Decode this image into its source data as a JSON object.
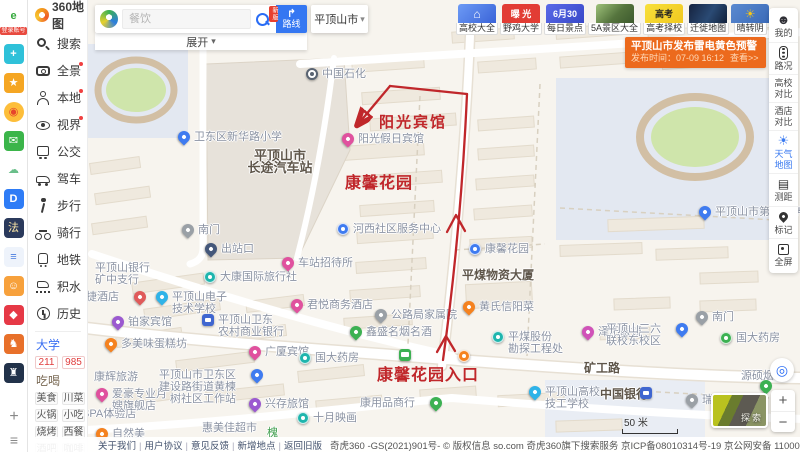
{
  "browser_strip": {
    "login_badge": "登录账号",
    "plus": "+",
    "menu": "≡",
    "icons": [
      {
        "name": "browser-e-logo",
        "glyph": "e",
        "bg": "#ffffff",
        "fg": "#35a93c",
        "bold": true,
        "first": true
      },
      {
        "name": "health-app-icon",
        "glyph": "+",
        "bg": "#2fc1d9",
        "fg": "#ffffff",
        "bold": true
      },
      {
        "name": "favorites-star-icon",
        "glyph": "★",
        "bg": "#f5a623",
        "fg": "#ffffff"
      },
      {
        "name": "weibo-icon",
        "glyph": "◉",
        "bg": "#fdbe3a",
        "fg": "#e6462c",
        "round": true
      },
      {
        "name": "mail-icon",
        "glyph": "✉",
        "bg": "#3bb54a",
        "fg": "#ffffff"
      },
      {
        "name": "cloud-icon",
        "glyph": "☁",
        "bg": "#ffffff",
        "fg": "#6abf8a"
      },
      {
        "name": "d-app-icon",
        "glyph": "D",
        "bg": "#2e7cf6",
        "fg": "#ffffff",
        "bold": true
      },
      {
        "name": "law-qa-icon",
        "glyph": "法",
        "bg": "#2b3a5c",
        "fg": "#ffe9a8"
      },
      {
        "name": "doc-icon",
        "glyph": "≡",
        "bg": "#eef3fb",
        "fg": "#4a7de0",
        "bold": true
      },
      {
        "name": "game-monkey-icon",
        "glyph": "☺",
        "bg": "#f7a13c",
        "fg": "#ffffff"
      },
      {
        "name": "red-app-icon",
        "glyph": "◆",
        "bg": "#e63946",
        "fg": "#ffffff"
      },
      {
        "name": "game-fight-icon",
        "glyph": "♞",
        "bg": "#e8702a",
        "fg": "#ffffff"
      },
      {
        "name": "game-dark-icon",
        "glyph": "♜",
        "bg": "#22324a",
        "fg": "#ffffff"
      }
    ]
  },
  "sidebar": {
    "logo_text": "360地图",
    "items": [
      {
        "label": "搜索",
        "icon": "search",
        "badge": false
      },
      {
        "label": "全景",
        "icon": "pano",
        "badge": true
      },
      {
        "label": "本地",
        "icon": "local",
        "badge": true
      },
      {
        "label": "视界",
        "icon": "view",
        "badge": true
      },
      {
        "label": "公交",
        "icon": "bus",
        "badge": false
      },
      {
        "label": "驾车",
        "icon": "car",
        "badge": false
      },
      {
        "label": "步行",
        "icon": "walk",
        "badge": false
      },
      {
        "label": "骑行",
        "icon": "bike",
        "badge": false
      },
      {
        "label": "地铁",
        "icon": "metro",
        "badge": false
      },
      {
        "label": "积水",
        "icon": "flood",
        "badge": false
      },
      {
        "label": "历史",
        "icon": "history",
        "badge": false
      }
    ],
    "university": {
      "title": "大学",
      "tags": [
        "211",
        "985"
      ]
    },
    "food": {
      "title": "吃喝",
      "tags": [
        "美食",
        "川菜",
        "火锅",
        "小吃",
        "烧烤",
        "西餐",
        "酒吧",
        "咖啡"
      ]
    }
  },
  "search": {
    "placeholder": "餐饮",
    "route_label": "路线",
    "route_badge": "新版",
    "city": "平顶山市",
    "expand_label": "展开"
  },
  "top_chips": [
    {
      "label": "高校大全",
      "tile": "uni",
      "tile_text": "⌂"
    },
    {
      "label": "野鸡大学",
      "tile": "expose",
      "tile_text": "曝 光"
    },
    {
      "label": "每日景点",
      "tile": "daily",
      "tile_text": "6月30"
    },
    {
      "label": "5A景区大全",
      "tile": "scenic",
      "tile_text": ""
    },
    {
      "label": "高考择校",
      "tile": "gaokao",
      "tile_text": "高考"
    },
    {
      "label": "迁徙地图",
      "tile": "migrate",
      "tile_text": ""
    },
    {
      "label": "晴转阴",
      "tile": "weather",
      "tile_text": "☀"
    }
  ],
  "alert": {
    "title": "平顶山市发布雷电黄色预警",
    "time": "发布时间：07-09 16:12",
    "action": "查看>>"
  },
  "right_tools": [
    {
      "label": "我的",
      "icon": "face"
    },
    {
      "label": "路况",
      "icon": "signal"
    },
    {
      "label": "高校对比",
      "icon": null
    },
    {
      "label": "酒店对比",
      "icon": null
    },
    {
      "label": "天气地图",
      "icon": "sun",
      "accent": true
    },
    {
      "label": "测距",
      "icon": "ruler"
    },
    {
      "label": "标记",
      "icon": "pin"
    },
    {
      "label": "全屏",
      "icon": "screen"
    }
  ],
  "map": {
    "scale_label": "50 米",
    "explore_label": "探索",
    "zoom_in": "+",
    "zoom_out": "−",
    "locate_glyph": "◎",
    "pois": [
      {
        "x": 306,
        "y": 68,
        "t": "gas",
        "l": "中国石化",
        "name": "poi-sinopec"
      },
      {
        "x": 178,
        "y": 131,
        "t": "pin",
        "c": "#3f7bf0",
        "l": "卫东区新华路小学",
        "name": "poi-xinhua-road-school"
      },
      {
        "x": 280,
        "y": 150,
        "t": "label",
        "lines": [
          "平顶山市",
          "长途汽车站"
        ],
        "b": true,
        "ctr": true,
        "size": 13,
        "name": "label-longdistance-bus-station"
      },
      {
        "x": 342,
        "y": 133,
        "t": "pin",
        "c": "#e0519e",
        "l": "阳光假日宾馆",
        "name": "poi-sunshine-holiday-hotel"
      },
      {
        "x": 182,
        "y": 224,
        "t": "pin",
        "c": "#9aa0a6",
        "l": "南门",
        "name": "poi-south-gate-west"
      },
      {
        "x": 205,
        "y": 243,
        "t": "pin",
        "c": "#44577a",
        "l": "出站口",
        "name": "poi-station-exit"
      },
      {
        "x": 337,
        "y": 223,
        "t": "round",
        "c": "#3f7bf0",
        "l": "河西社区服务中心",
        "name": "poi-hexi-community-center"
      },
      {
        "x": 95,
        "y": 262,
        "t": "label",
        "lines": [
          "平顶山银行",
          "矿中支行"
        ],
        "name": "label-pds-bank-branch"
      },
      {
        "x": 204,
        "y": 271,
        "t": "round",
        "c": "#1fb5ad",
        "l": "大康国际旅行社",
        "name": "poi-dakang-travel"
      },
      {
        "x": 282,
        "y": 257,
        "t": "pin",
        "c": "#e0519e",
        "l": "车站招待所",
        "name": "poi-station-hostel"
      },
      {
        "x": 134,
        "y": 291,
        "t": "pin",
        "c": "#e05a5a",
        "l": "汉和快捷酒店",
        "side": "left",
        "name": "poi-hanhe-express-hotel"
      },
      {
        "x": 156,
        "y": 291,
        "t": "pin",
        "c": "#2fb3e8",
        "lines": [
          "平顶山电子",
          "技术学校"
        ],
        "name": "poi-electronics-tech-school"
      },
      {
        "x": 112,
        "y": 316,
        "t": "pin",
        "c": "#9b59d0",
        "l": "铂家宾馆",
        "name": "poi-bojia-hotel"
      },
      {
        "x": 202,
        "y": 314,
        "t": "square",
        "c": "#3f66d0",
        "lines": [
          "平顶山卫东",
          "农村商业银行"
        ],
        "name": "poi-weidong-rural-bank"
      },
      {
        "x": 105,
        "y": 338,
        "t": "pin",
        "c": "#f5821f",
        "l": "多美味蛋糕坊",
        "name": "poi-cake-shop"
      },
      {
        "x": 249,
        "y": 346,
        "t": "pin",
        "c": "#e0519e",
        "l": "广厦宾馆",
        "name": "poi-guangsha-hotel"
      },
      {
        "x": 299,
        "y": 352,
        "t": "round",
        "c": "#1fb5ad",
        "l": "国大药房",
        "name": "poi-guoda-pharmacy-west"
      },
      {
        "x": 291,
        "y": 299,
        "t": "pin",
        "c": "#e0519e",
        "l": "君悦商务酒店",
        "name": "poi-junyue-hotel"
      },
      {
        "x": 375,
        "y": 309,
        "t": "pin",
        "c": "#9aa0a6",
        "l": "公路局家属院",
        "name": "poi-highway-bureau-compound"
      },
      {
        "x": 350,
        "y": 326,
        "t": "pin",
        "c": "#3cb152",
        "l": "鑫盛名烟名酒",
        "name": "poi-xinsheng-tobacco"
      },
      {
        "x": 94,
        "y": 371,
        "t": "label",
        "lines": [
          "康辉旅游"
        ],
        "name": "label-kanghui-travel"
      },
      {
        "x": 96,
        "y": 388,
        "t": "pin",
        "c": "#e0519e",
        "lines": [
          "爱豪专业月",
          "嫂旗舰店"
        ],
        "name": "poi-aihao-store"
      },
      {
        "x": 82,
        "y": 408,
        "t": "label",
        "lines": [
          "SPA体验店"
        ],
        "name": "label-spa-store"
      },
      {
        "x": 96,
        "y": 428,
        "t": "pin",
        "c": "#f5821f",
        "l": "自然美",
        "name": "poi-natural-beauty"
      },
      {
        "x": 251,
        "y": 369,
        "t": "pin",
        "c": "#3f7bf0",
        "lines": [
          "平顶山市卫东区",
          "建设路街道黄楝",
          "树社区工作站"
        ],
        "side": "left",
        "name": "poi-community-workstation"
      },
      {
        "x": 249,
        "y": 398,
        "t": "pin",
        "c": "#9b59d0",
        "l": "兴存旅馆",
        "name": "poi-xingcun-inn"
      },
      {
        "x": 297,
        "y": 412,
        "t": "round",
        "c": "#1fb5ad",
        "l": "十月映画",
        "name": "poi-october-cinema"
      },
      {
        "x": 202,
        "y": 422,
        "t": "label",
        "lines": [
          "惠美佳超市"
        ],
        "name": "label-huimeijia-market"
      },
      {
        "x": 582,
        "y": 326,
        "t": "pin",
        "c": "#d052b8",
        "l": "泽阳眼镜",
        "name": "poi-zeyang-glasses"
      },
      {
        "x": 492,
        "y": 331,
        "t": "round",
        "c": "#1fb5ad",
        "lines": [
          "平煤股份",
          "勘探工程处"
        ],
        "name": "poi-pingmei-exploration"
      },
      {
        "x": 676,
        "y": 323,
        "t": "pin",
        "c": "#3f7bf0",
        "lines": [
          "平顶山三六",
          "联校东校区"
        ],
        "side": "left",
        "name": "poi-36-united-school"
      },
      {
        "x": 696,
        "y": 311,
        "t": "pin",
        "c": "#9aa0a6",
        "l": "南门",
        "name": "poi-south-gate-east"
      },
      {
        "x": 720,
        "y": 332,
        "t": "round",
        "c": "#3cb152",
        "l": "国大药房",
        "name": "poi-guoda-pharmacy-east"
      },
      {
        "x": 529,
        "y": 386,
        "t": "pin",
        "c": "#2fb3e8",
        "lines": [
          "平顶山高校",
          "技工学校"
        ],
        "name": "poi-technical-school"
      },
      {
        "x": 600,
        "y": 388,
        "t": "label",
        "lines": [
          "中国银行"
        ],
        "b": true,
        "name": "label-bank-of-china"
      },
      {
        "x": 640,
        "y": 387,
        "t": "square",
        "c": "#3f66d0",
        "l": "",
        "name": "poi-bank-of-china-icon"
      },
      {
        "x": 686,
        "y": 394,
        "t": "pin",
        "c": "#9aa0a6",
        "l": "瑞",
        "name": "poi-rui"
      },
      {
        "x": 741,
        "y": 370,
        "t": "label",
        "lines": [
          "源硕烟酒"
        ],
        "name": "label-yuanshuo-tobacco"
      },
      {
        "x": 760,
        "y": 380,
        "t": "pin",
        "c": "#3cb152",
        "l": "",
        "name": "poi-green-pin"
      },
      {
        "x": 469,
        "y": 243,
        "t": "round",
        "c": "#3f7bf0",
        "l": "康馨花园",
        "name": "poi-kangxin-garden"
      },
      {
        "x": 462,
        "y": 269,
        "t": "label",
        "lines": [
          "平煤物资大厦"
        ],
        "b": true,
        "name": "label-pingmei-materials-building"
      },
      {
        "x": 463,
        "y": 301,
        "t": "pin",
        "c": "#f5821f",
        "l": "黄氏信阳菜",
        "name": "poi-huangshi-restaurant"
      },
      {
        "x": 699,
        "y": 206,
        "t": "pin",
        "c": "#3f7bf0",
        "l": "平顶山市第三中学",
        "name": "poi-third-middle-school"
      },
      {
        "x": 399,
        "y": 349,
        "t": "bus",
        "c": "#3cb152",
        "l": "",
        "name": "poi-bus-stop"
      },
      {
        "x": 458,
        "y": 350,
        "t": "round",
        "c": "#f5821f",
        "l": "",
        "name": "poi-orange-dot"
      },
      {
        "x": 430,
        "y": 397,
        "t": "pin",
        "c": "#3cb152",
        "l": "康用品商行",
        "side": "left",
        "name": "poi-kang-goods-store"
      },
      {
        "x": 602,
        "y": 362,
        "t": "label",
        "lines": [
          "矿工路"
        ],
        "b": true,
        "ctr": true,
        "name": "label-kuanggong-road"
      },
      {
        "x": 267,
        "y": 427,
        "t": "label",
        "lines": [
          "槐"
        ],
        "color": "#3f9e4d",
        "name": "label-huai-street"
      }
    ],
    "annotation": {
      "color": "#c0272b",
      "texts": [
        {
          "t": "阳光宾馆",
          "x": 379,
          "y": 111,
          "s": 15,
          "ls": 2
        },
        {
          "t": "康馨花园",
          "x": 345,
          "y": 169,
          "s": 16,
          "ls": 1
        },
        {
          "t": "康馨花园入口",
          "x": 377,
          "y": 361,
          "s": 16,
          "ls": 1
        }
      ]
    }
  },
  "bottom_bar": {
    "links": [
      "关于我们",
      "用户协议",
      "意见反馈",
      "新增地点",
      "返回旧版"
    ],
    "copyright": "奇虎360 -GS(2021)901号- © 版权信息 so.com  奇虎360旗下搜索服务  京ICP备08010314号-19  京公网安备 11000002000022号  京ICP证080047号  工商营业执照"
  }
}
